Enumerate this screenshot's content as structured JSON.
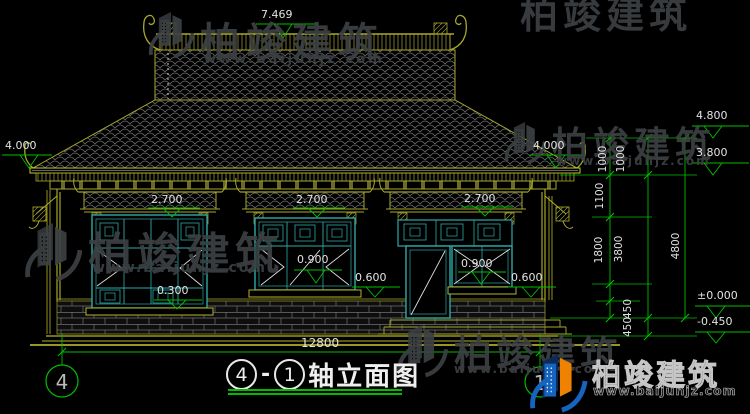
{
  "drawing": {
    "title_axis_start": "4",
    "title_separator": "-",
    "title_axis_end": "1",
    "title_text": "轴立面图",
    "axis_left": "4",
    "axis_right": "1"
  },
  "levels": {
    "ridge": "7.469",
    "eaves_left": "4.000",
    "eaves_right": "4.000",
    "right_upper": "4.800",
    "right_eaves": "3.800",
    "floor": "±0.000",
    "site": "-0.450",
    "lintel_left": "2.700",
    "lintel_mid": "2.700",
    "lintel_right": "2.700",
    "sill_mid": "0.900",
    "sill_right": "0.900",
    "plinth_mid": "0.600",
    "plinth_right": "0.600",
    "sill_left": "0.300"
  },
  "dims": {
    "total_width": "12800",
    "v1000_a": "1000",
    "v1000_b": "1000",
    "v1100": "1100",
    "v1800": "1800",
    "v3800": "3800",
    "v4800": "4800",
    "v450_a": "450",
    "v450_b": "450"
  },
  "watermark": {
    "brand": "柏竣建筑",
    "url": "www.baijunjz.com"
  },
  "colors": {
    "cad_yellow": "#b5b52a",
    "cad_green": "#00bf00",
    "cad_teal": "#2fa8a8",
    "dim_text": "#e2e2e2",
    "logo_blue": "#1565c0",
    "logo_orange": "#ef8200"
  }
}
